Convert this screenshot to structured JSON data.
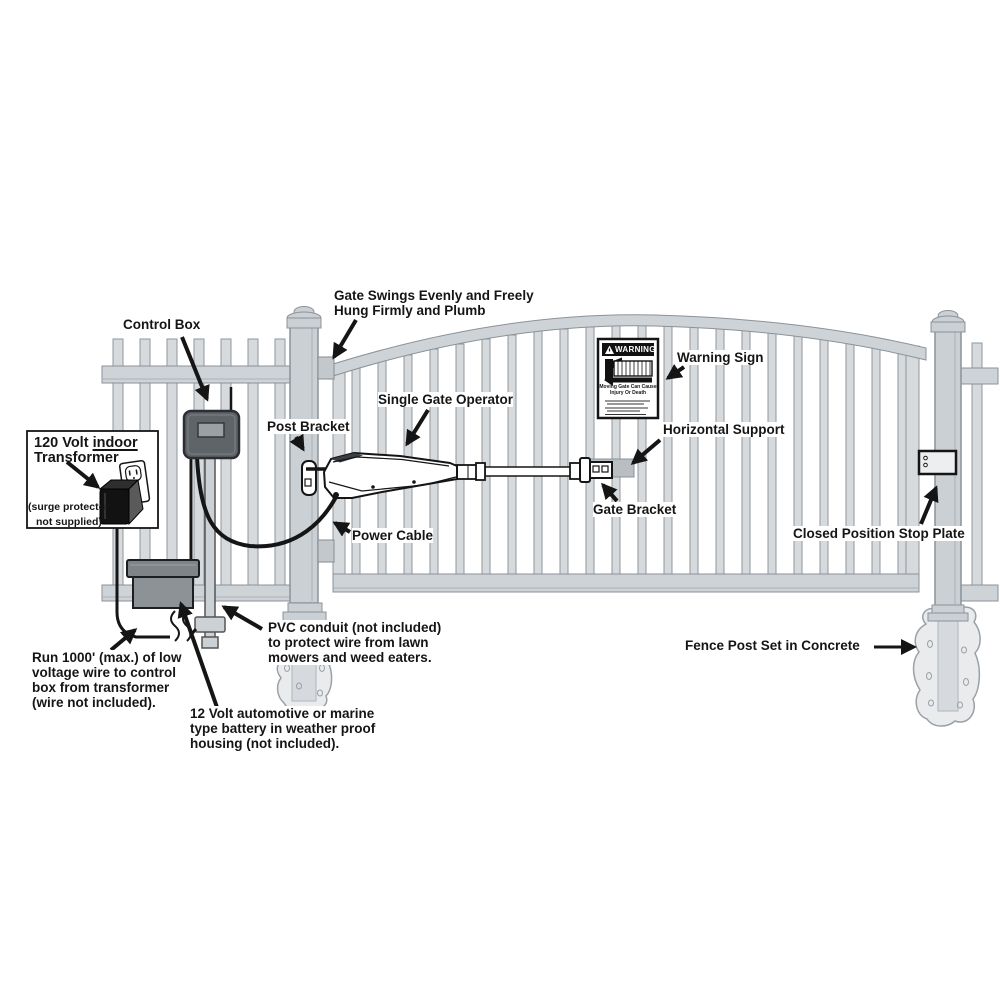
{
  "diagram_title": "Single gate operator installation diagram",
  "labels": {
    "control_box": "Control Box",
    "gate_swings": [
      "Gate Swings Evenly and Freely",
      "Hung Firmly and Plumb"
    ],
    "post_bracket": "Post Bracket",
    "single_gate_operator": "Single Gate Operator",
    "warning_sign": "Warning Sign",
    "horizontal_support": "Horizontal Support",
    "gate_bracket": "Gate Bracket",
    "power_cable": "Power Cable",
    "closed_position_stop_plate": "Closed Position Stop Plate",
    "fence_post": "Fence Post Set in Concrete",
    "pvc_conduit": [
      "PVC conduit (not included)",
      "to protect wire from lawn",
      "mowers and weed eaters."
    ],
    "run_wire": [
      "Run 1000' (max.) of low",
      "voltage wire to control",
      "box from transformer",
      "(wire not included)."
    ],
    "battery_12v": [
      "12 Volt automotive or marine",
      "type battery in weather proof",
      "housing (not included)."
    ],
    "transformer": {
      "line1_prefix": "120 Volt ",
      "line1_underlined": "indoor",
      "line2": "Transformer",
      "note_line1": "(surge protector",
      "note_line2": "not supplied)"
    },
    "warning_panel": {
      "header": "WARNING",
      "body": [
        "Moving Gate Can Cause",
        "Injury Or Death"
      ]
    }
  },
  "colors": {
    "fence_fill": "#ced3d7",
    "fence_edge": "#8b9298",
    "picket_fill": "#d6dadd",
    "outline_dark": "#151515",
    "control_box_fill": "#5f6468",
    "battery_fill": "#8d9296",
    "concrete_fill": "#e9ebed",
    "support_bar_fill": "#b9bec3",
    "warning_band": "#111111",
    "background": "#ffffff"
  }
}
